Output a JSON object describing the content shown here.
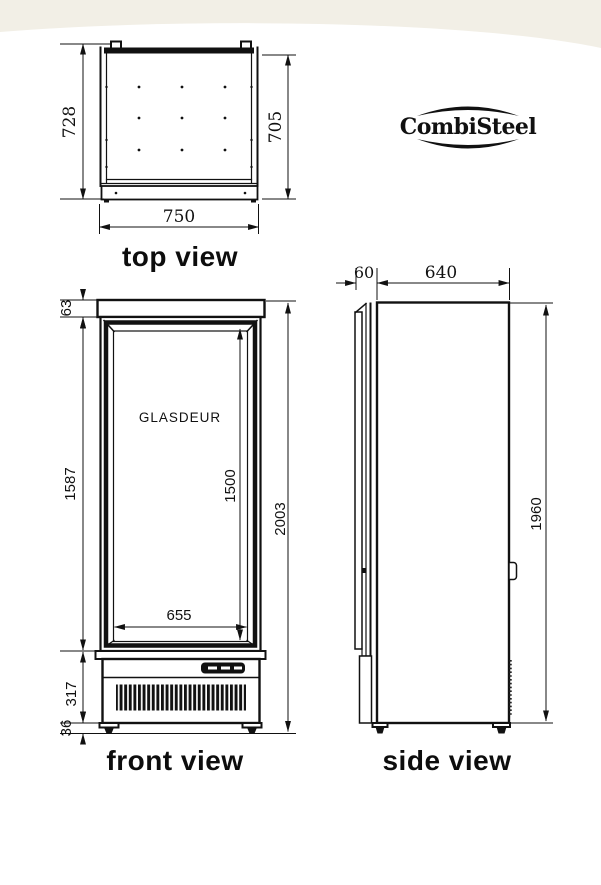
{
  "brand": {
    "logo_text": "CombiSteel"
  },
  "drawing": {
    "top_view": {
      "label": "top view",
      "outer_depth": "728",
      "inner_depth": "705",
      "width": "750"
    },
    "front_view": {
      "label": "front view",
      "door_label": "GLASDEUR",
      "top_frame_height": "63",
      "door_height": "1587",
      "base_height": "317",
      "feet_height": "36",
      "glass_width": "655",
      "glass_height": "1500",
      "total_height": "2003"
    },
    "side_view": {
      "label": "side view",
      "door_depth": "60",
      "body_depth": "640",
      "body_height": "1960"
    }
  },
  "colors": {
    "line": "#111111",
    "header_band": "#f2efe6",
    "background": "#ffffff"
  }
}
